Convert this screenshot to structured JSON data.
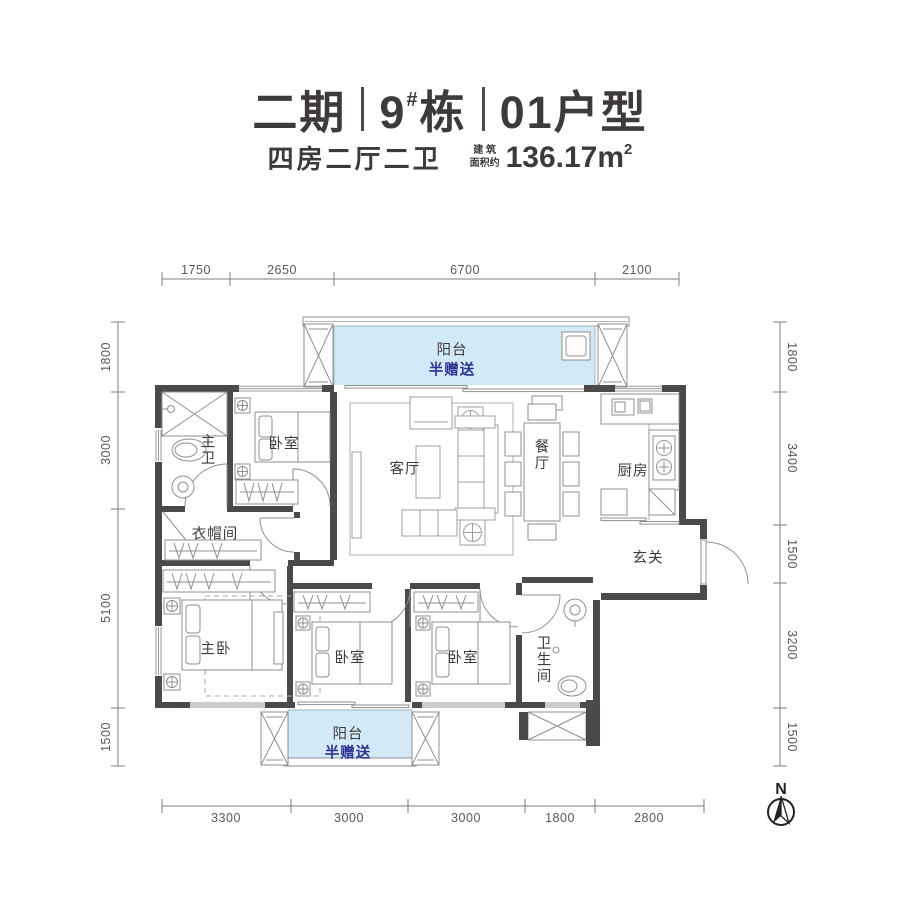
{
  "header": {
    "phase": "二期",
    "building_num": "9",
    "building_sup": "#",
    "building_unit": "栋",
    "unit": "01户型",
    "layout": "四房二厅二卫",
    "area_label": "建 筑\n面积约",
    "area_value": "136.17m",
    "area_exp": "2"
  },
  "dimensions": {
    "top": [
      "1750",
      "2650",
      "6700",
      "2100"
    ],
    "bottom": [
      "3300",
      "3000",
      "3000",
      "1800",
      "2800"
    ],
    "left": [
      "1800",
      "3000",
      "5100",
      "1500"
    ],
    "right": [
      "1800",
      "3400",
      "1500",
      "3200",
      "1500"
    ]
  },
  "rooms": {
    "balcony_top_name": "阳台",
    "balcony_top_note": "半赠送",
    "master_bath": "主卫",
    "bedroom_top": "卧室",
    "living_room": "客厅",
    "dining_room": "餐厅",
    "kitchen": "厨房",
    "cloakroom": "衣帽间",
    "foyer": "玄关",
    "master_bedroom": "主卧",
    "bedroom_mid": "卧室",
    "bedroom_right": "卧室",
    "bathroom": "卫生间",
    "balcony_bottom_name": "阳台",
    "balcony_bottom_note": "半赠送"
  },
  "compass": {
    "north": "N"
  },
  "colors": {
    "wall": "#4b4949",
    "balcony_fill": "#d2eaf8",
    "gift_text": "#2e3192",
    "label_text": "#3f3b3a",
    "dim_text": "#585858"
  }
}
